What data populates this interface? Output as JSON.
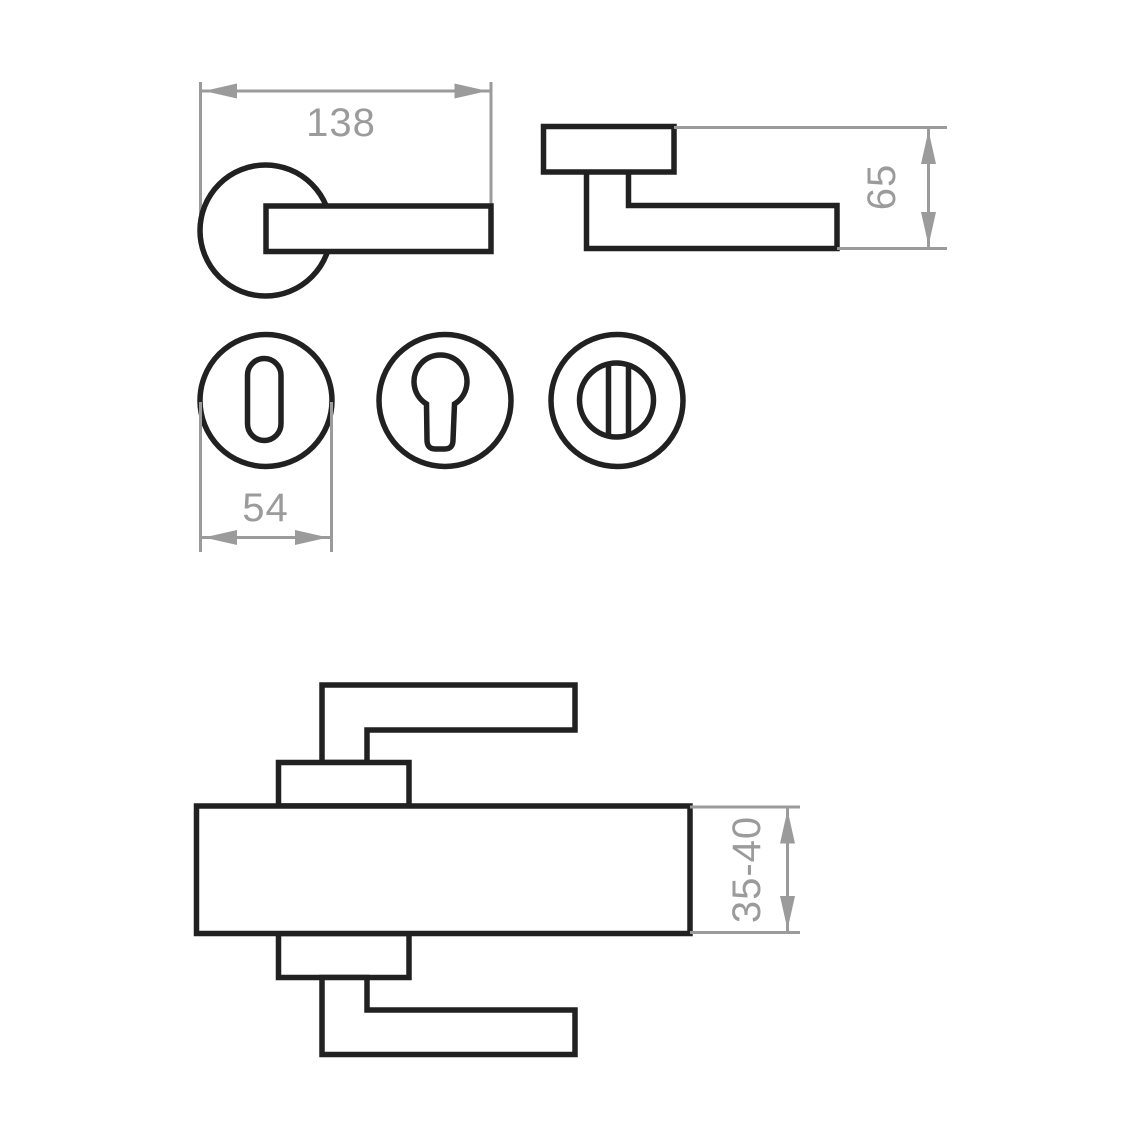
{
  "canvas": {
    "background": "#ffffff",
    "width": 1140,
    "height": 1140
  },
  "colors": {
    "outline": "#212121",
    "dimension": "#9b9b9b"
  },
  "views": {
    "handle_front": {
      "length_label": "138"
    },
    "handle_side": {
      "projection_label": "65"
    },
    "escutcheons": {
      "diameter_label": "54"
    },
    "door_section": {
      "thickness_label": "35-40"
    }
  }
}
